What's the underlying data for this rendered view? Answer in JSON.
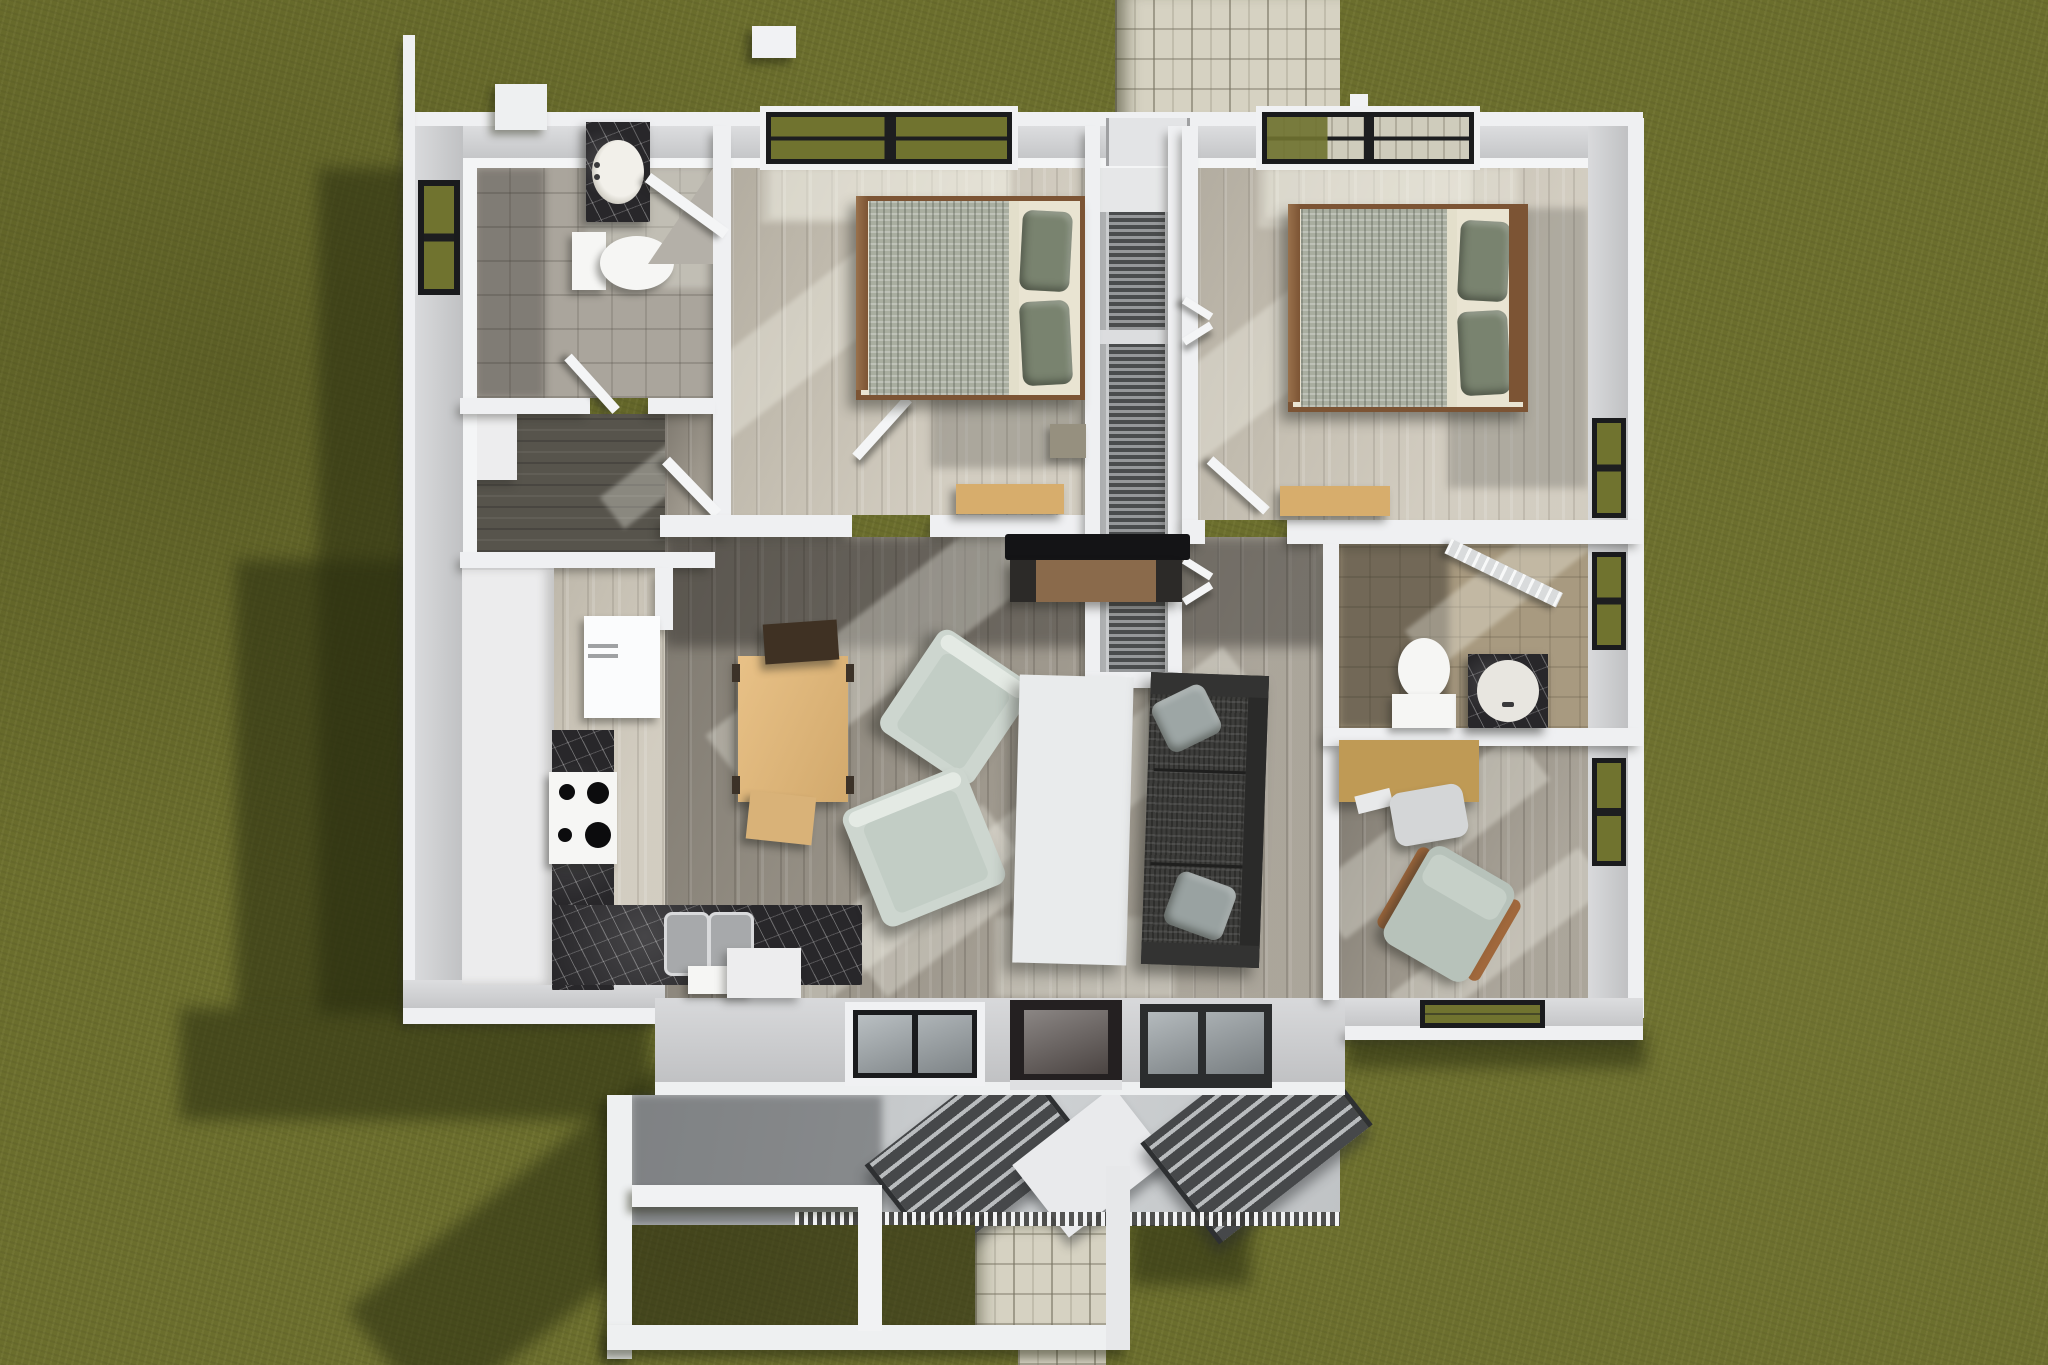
{
  "scene": {
    "description": "3D top-down architectural rendering of a single-story house floor plan set on a mottled olive-green lawn, with paver walkways at the rear and front, a covered front porch with steps, two bedrooms with beds and desks, two bathrooms, a laundry room, kitchen with L-shaped black marble counters, dining table, living room with sofa, two armchairs, coffee table and TV console, a stair corridor, and a home office",
    "view": "overhead bird's-eye",
    "time_of_day": "daytime with hard sunlight from upper right casting long shadows to the lower left"
  },
  "palette": {
    "grass": "#6b6e2d",
    "grassShadow": "#282b0e",
    "paver": "#d6d2c2",
    "wallWhite": "#eff0f2",
    "wallFace": "#d8d9db",
    "marble": "#28272a",
    "fixtureWhite": "#f6f6f4",
    "frameDark": "#1a1b1d",
    "glassGreen": "#70732f",
    "doorDark": "#242021",
    "mattress": "#e9e4d2",
    "bedFrame": "#7c5434",
    "blanket": "#a9aea0",
    "pillow": "#79836f",
    "sofa": "#3d3d3b",
    "sofaPillow": "#9da6a5",
    "armchair": "#cdd6cf",
    "coffeeTable": "#e9ebec",
    "woodTan": "#dfb87e",
    "deskTan": "#bf9a55",
    "consoleWood": "#8a6a4b",
    "tv": "#141416",
    "concrete": "#c6c9cb"
  },
  "house": {
    "rooms": [
      {
        "name": "lawn",
        "items": [
          "grass",
          "cast building shadows"
        ]
      },
      {
        "name": "rear walkway",
        "items": [
          "paver path to back door"
        ]
      },
      {
        "name": "front walkway",
        "items": [
          "paver path from porch"
        ]
      },
      {
        "name": "bedroom 1",
        "items": [
          "double bed",
          "pillows",
          "desk",
          "window",
          "nightstand",
          "door"
        ]
      },
      {
        "name": "bedroom 2",
        "items": [
          "double bed",
          "pillows",
          "desk",
          "window",
          "bifold closet doors",
          "door"
        ]
      },
      {
        "name": "hall bathroom",
        "items": [
          "marble vanity with oval sink",
          "toilet",
          "corner shower",
          "window"
        ]
      },
      {
        "name": "ensuite bathroom",
        "items": [
          "toilet",
          "marble vanity with round sink",
          "louvered door",
          "window"
        ]
      },
      {
        "name": "laundry room",
        "items": [
          "open door",
          "dark wood floor"
        ]
      },
      {
        "name": "kitchen",
        "items": [
          "refrigerator",
          "pantry cabinets",
          "range with four burners",
          "black marble counters",
          "double sink",
          "dishwasher",
          "island block"
        ]
      },
      {
        "name": "dining area",
        "items": [
          "wood dining table",
          "dark chair",
          "tan chair"
        ]
      },
      {
        "name": "living room",
        "items": [
          "TV",
          "media console",
          "two armchairs",
          "white coffee table",
          "charcoal sofa with pillows"
        ]
      },
      {
        "name": "stair corridor",
        "items": [
          "back door landing",
          "stair flights"
        ]
      },
      {
        "name": "home office",
        "items": [
          "desk",
          "office chair",
          "reading chair with wood arms",
          "windows"
        ]
      },
      {
        "name": "front porch",
        "items": [
          "concrete slab",
          "two angled step flights",
          "baluster railing",
          "white beams",
          "front door",
          "front windows"
        ]
      }
    ]
  }
}
